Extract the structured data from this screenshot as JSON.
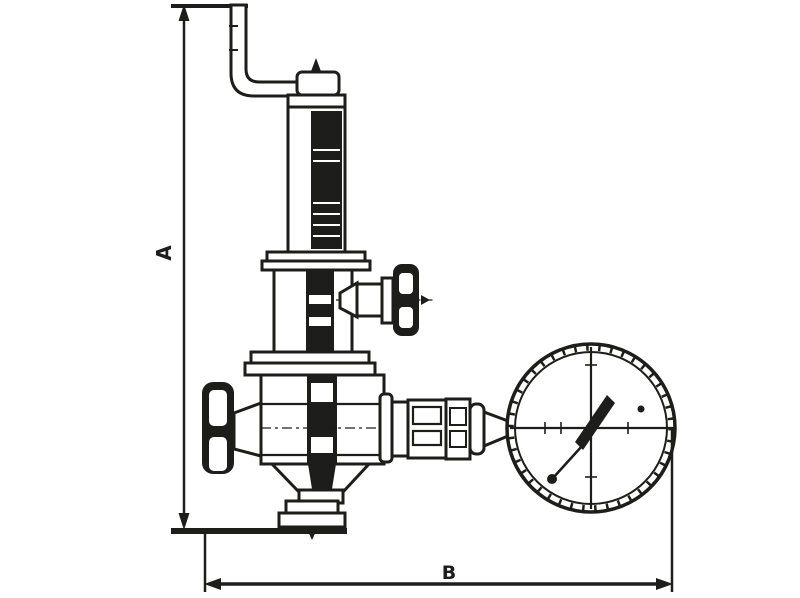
{
  "diagram": {
    "background_color": "#ffffff",
    "line_color": "#1d1d1b",
    "dimensions": {
      "height_label": "A",
      "width_label": "B"
    },
    "parts": [
      "discharge-elbow-pipe",
      "adjusting-screw-tip",
      "spring-housing",
      "bonnet",
      "side-handwheel",
      "inlet-handwheel",
      "valve-body",
      "bottom-outlet-flange",
      "gauge-connection-fittings",
      "pressure-gauge"
    ]
  }
}
